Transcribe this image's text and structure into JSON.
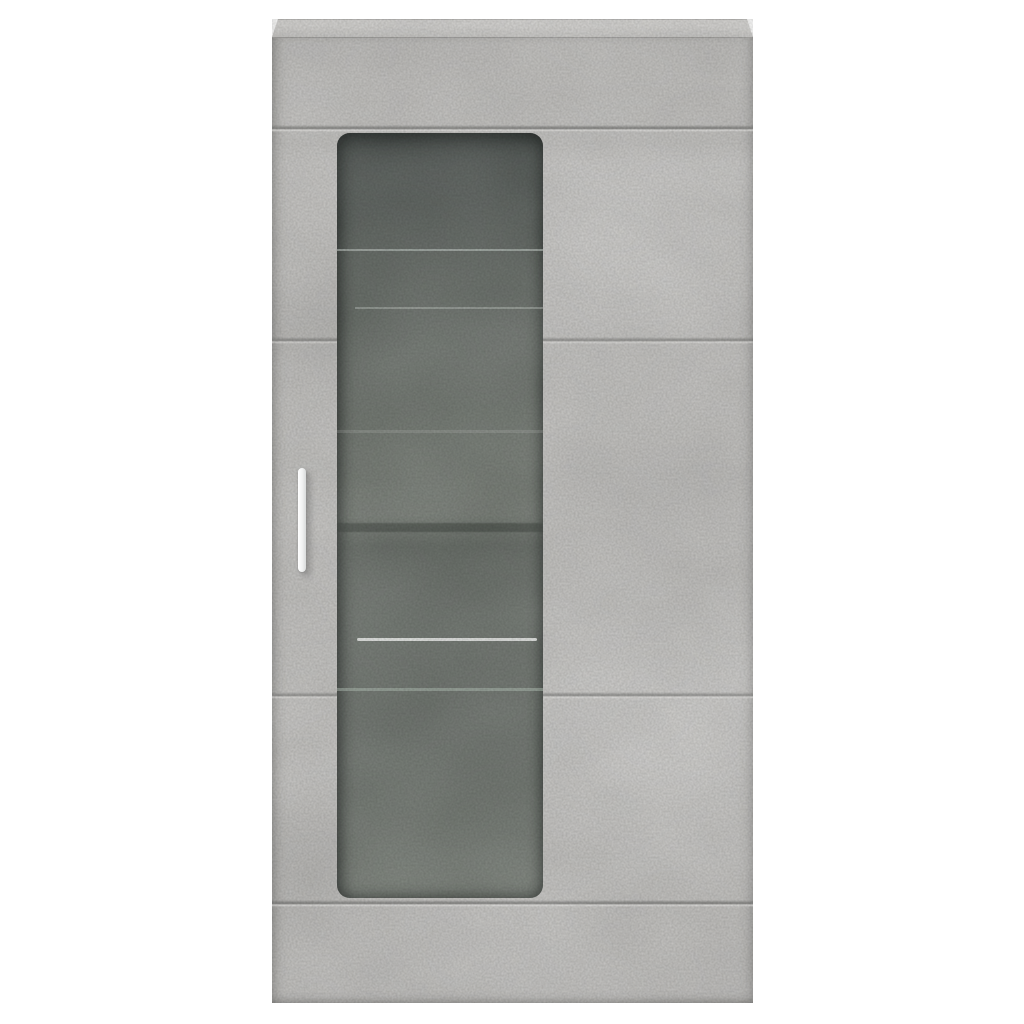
{
  "scene": {
    "type": "product-photo",
    "subject": "Wall-mounted storage cabinet with glass door",
    "material_finish": "concrete grey",
    "background": "plain white studio background"
  },
  "parts": {
    "cabinet": "concrete grey wall cabinet",
    "top_panel": "cabinet top panel",
    "front_panel": "concrete-look front panel",
    "panel_seam": "horizontal concrete shuttering seam",
    "glass_door": "tinted glass door window with rounded corners",
    "glass_shelf": "glass shelf edge",
    "dark_shelf": "dark shelf band inside cabinet",
    "handle": "vertical white door handle"
  },
  "colors": {
    "background": "#ffffff",
    "concrete_base": "#c6c5c3",
    "concrete_band": "#c2c1bf",
    "concrete_lighter": "#cac9c7",
    "top_face_light": "#d8d7d5",
    "top_face_deep": "#cbcac8",
    "seam_dark": "#7e7e7c",
    "seam_light": "#efeeec",
    "glass_top": "#4b514e",
    "glass_upper": "#5c625e",
    "glass_mid": "#6f756f",
    "glass_light": "#7b817a",
    "glass_deep": "#676d67",
    "shelf_light": "#cfd8d3",
    "shelf_bright": "#f2f5f2",
    "shelf_dark": "#2e342f",
    "shelf_green": "#b7c7bb",
    "handle": "#ffffff",
    "handle_edge": "#d9dada"
  }
}
